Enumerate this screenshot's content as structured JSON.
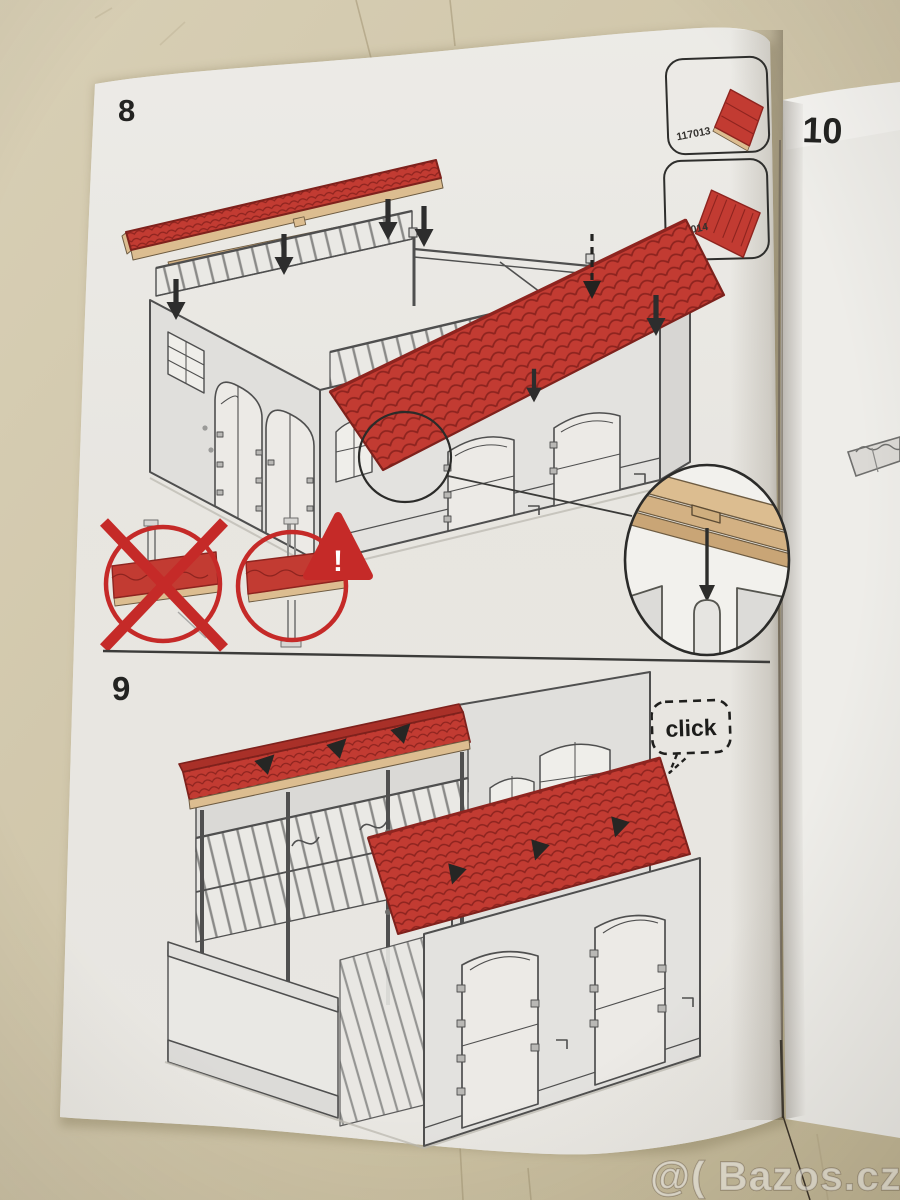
{
  "manual": {
    "step_labels": {
      "step8": "8",
      "step9": "9",
      "step10": "10"
    },
    "parts": [
      {
        "number": "117013"
      },
      {
        "number": "117014"
      }
    ],
    "click_label": "click",
    "warning_exclamation": "!"
  },
  "watermark": {
    "text": "@( Bazos.cz"
  },
  "colors": {
    "table_surface": "#cfc5a9",
    "paper": "#e9e7e2",
    "paper_right": "#eeede9",
    "roof_red": "#c23b32",
    "roof_red_dark": "#7e211c",
    "wood_tan": "#dcbd90",
    "warning_red": "#c52a28",
    "line_art": "#4f4f4f",
    "arrow_black": "#2d2d2d"
  }
}
